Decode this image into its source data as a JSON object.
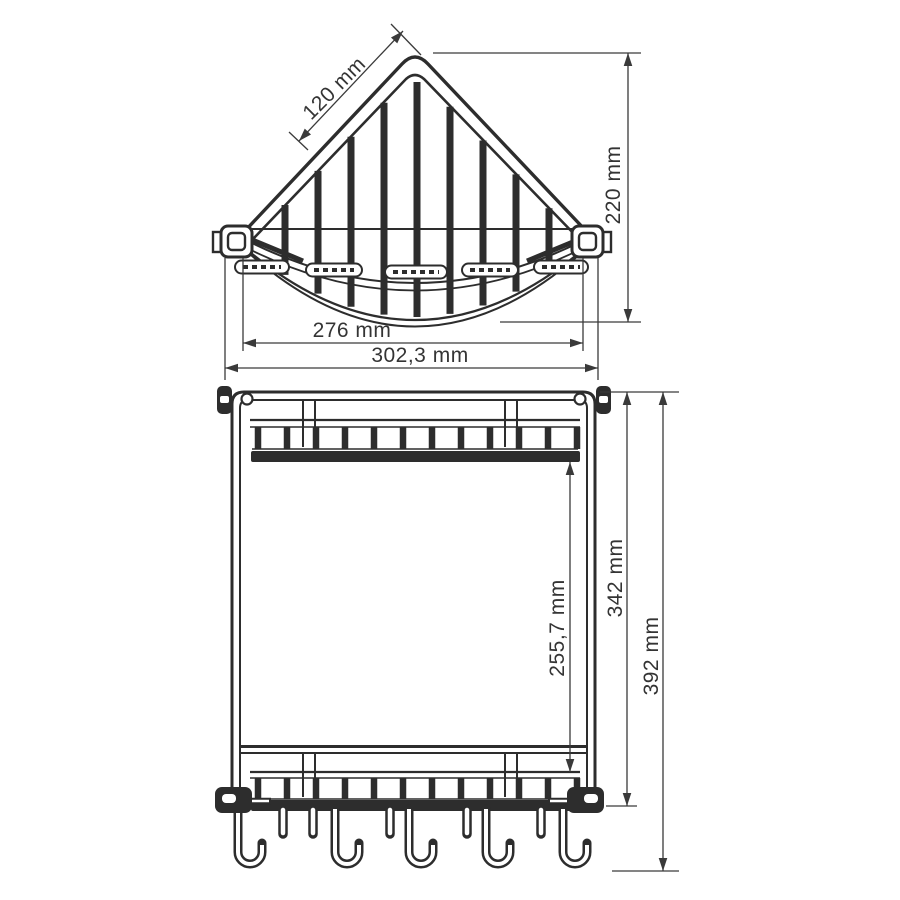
{
  "colors": {
    "line": "#2d2d2d",
    "dimension": "#3a3a3a",
    "background": "#ffffff"
  },
  "views": {
    "top_view": {
      "dimensions": {
        "edge_length": "120 mm",
        "height": "220 mm",
        "inner_width": "276 mm",
        "outer_width": "302,3 mm"
      }
    },
    "front_view": {
      "dimensions": {
        "shelf_clearance": "255,7 mm",
        "frame_height": "342 mm",
        "total_height": "392 mm"
      }
    }
  }
}
